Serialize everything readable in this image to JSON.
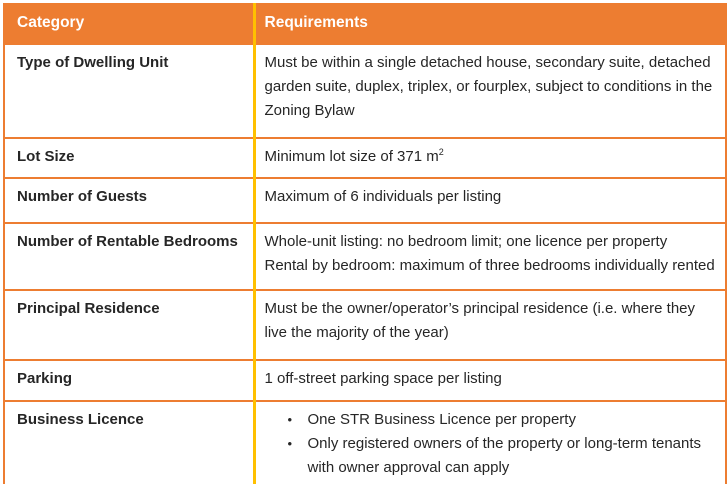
{
  "table": {
    "bullet_glyph": "•",
    "colors": {
      "header_background": "#ED7D31",
      "header_text": "#FFFFFF",
      "row_separator": "#ED7D31",
      "column_divider": "#FFC000",
      "body_text": "#262626"
    },
    "header": {
      "category": "Category",
      "requirements": "Requirements"
    },
    "rows": [
      {
        "category": "Type of Dwelling Unit",
        "requirement": "Must be within a single detached house, secondary suite, detached garden suite, duplex, triplex, or fourplex, subject to conditions in the Zoning Bylaw"
      },
      {
        "category": "Lot Size",
        "requirement": "Minimum lot size of 371 m",
        "superscript": "2"
      },
      {
        "category": "Number of Guests",
        "requirement": "Maximum of 6 individuals per listing"
      },
      {
        "category": "Number of Rentable Bedrooms",
        "lines": [
          "Whole-unit listing: no bedroom limit; one licence per property",
          "Rental by bedroom: maximum of three bedrooms individually rented"
        ]
      },
      {
        "category": "Principal Residence",
        "requirement": "Must be the owner/operator’s principal residence (i.e. where they live the majority of the year)"
      },
      {
        "category": "Parking",
        "requirement": "1 off-street parking space per listing"
      },
      {
        "category": "Business Licence",
        "bullets": [
          "One STR Business Licence per property",
          "Only registered owners of the property or long-term tenants with owner approval can apply"
        ]
      }
    ]
  }
}
